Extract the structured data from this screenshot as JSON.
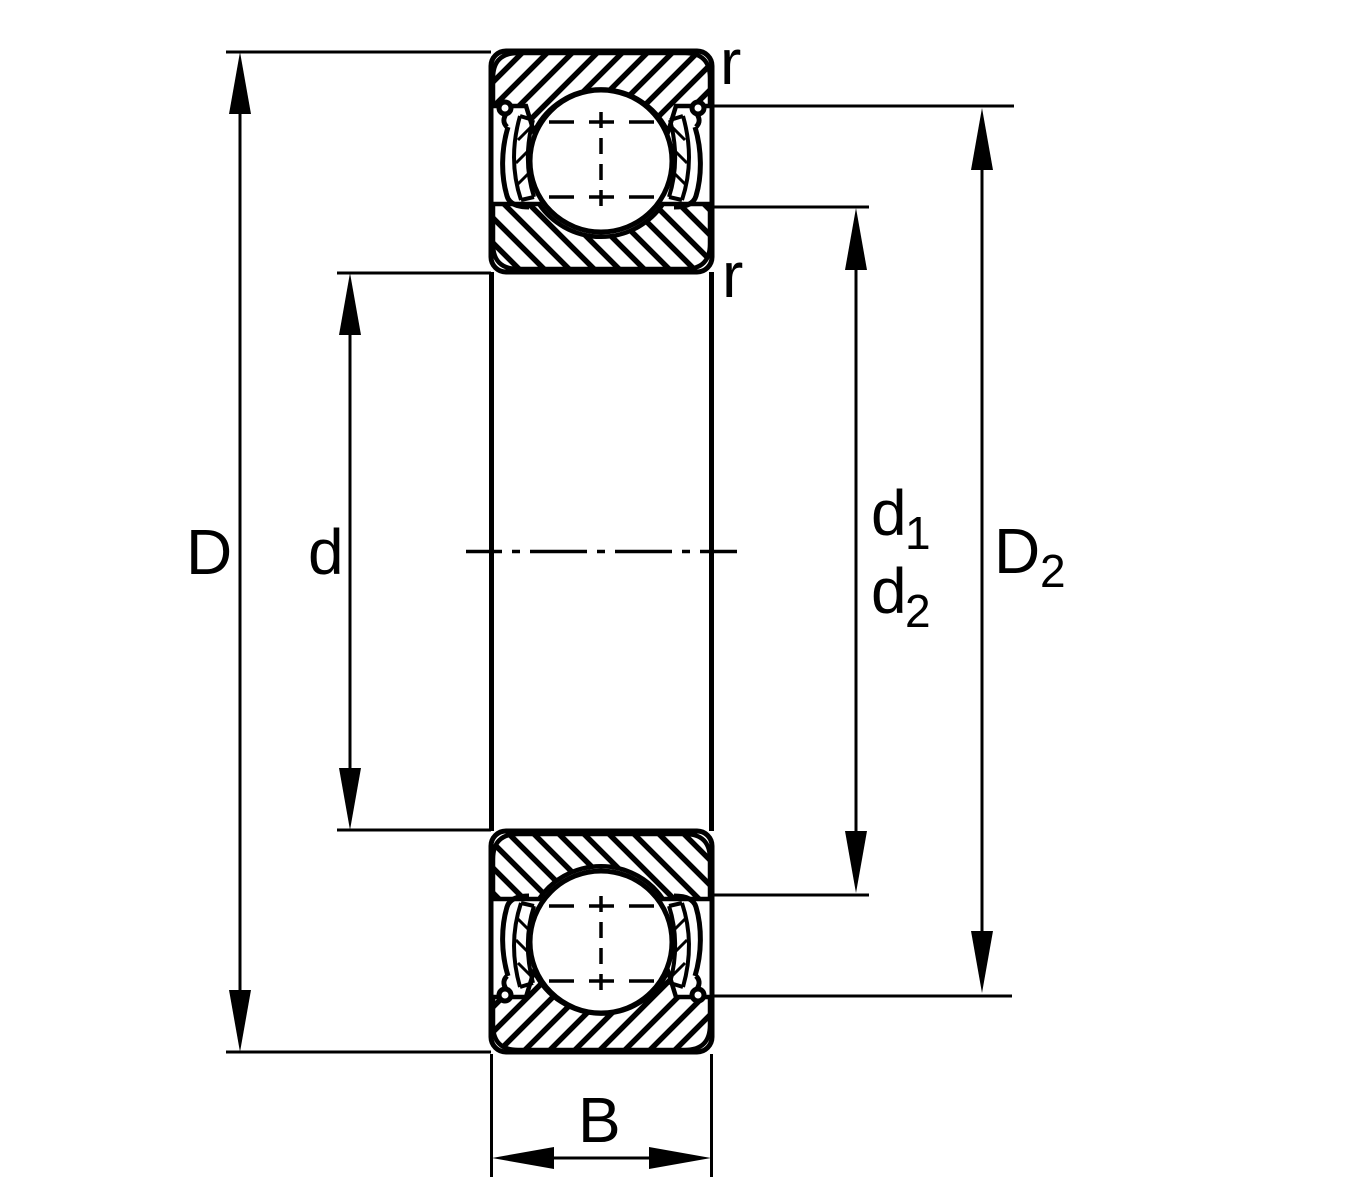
{
  "diagram": {
    "title": "Deep groove ball bearing cross-section dimension drawing",
    "background_color": "#ffffff",
    "line_color": "#000000",
    "labels": {
      "outer_diameter": "D",
      "bore_diameter": "d",
      "shield_dia_1": {
        "base": "d",
        "sub": "1"
      },
      "shield_dia_2": {
        "base": "d",
        "sub": "2"
      },
      "shoulder_dia": {
        "base": "D",
        "sub": "2"
      },
      "width": "B",
      "corner_radius_top": "r",
      "corner_radius_bottom": "r"
    }
  }
}
